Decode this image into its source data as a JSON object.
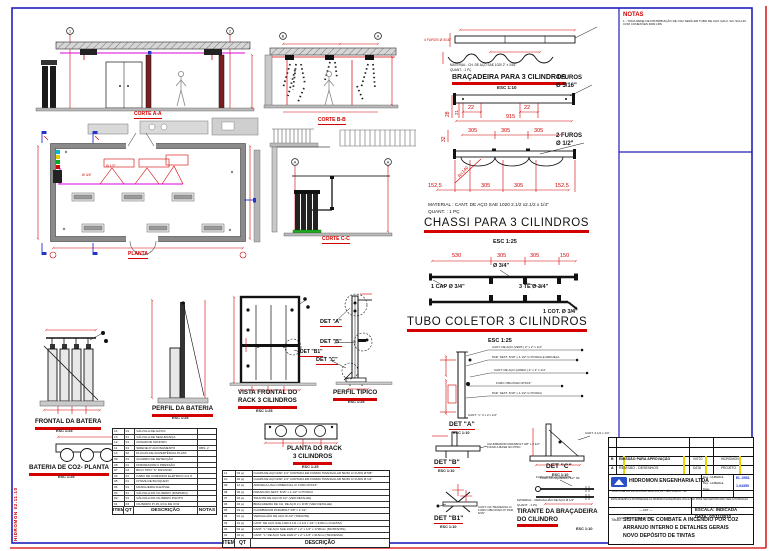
{
  "stamp": {
    "text": "HIDROMON 02.11.10"
  },
  "notas": {
    "title": "NOTAS",
    "line": "1 - TODA REDE DE DISTRIBUIÇÃO DE CO2 SERÁ EM TUBO DE AÇO GALV. S/C SCH-40 COM CONEXÕES 3000 LBS."
  },
  "cortes": {
    "a": "CORTE A-A",
    "b": "CORTE B-B",
    "c": "CORTE C-C",
    "planta": "PLANTA",
    "col1": "1",
    "col2": "2",
    "colA": "A",
    "colB": "B"
  },
  "plan": {
    "d12": "Ø 1/2\"",
    "d34": "Ø 3/4\""
  },
  "bracadeira": {
    "red_note": "4 FUROS Ø 5/16\"",
    "material": "MATERIAL : CH. DE AÇO SAE 1020 2\" x 3/16\"",
    "quant": "QUANT.   : 1 PÇ",
    "title": "BRAÇADEIRA PARA 3 CILINDROS",
    "esc": "ESC 1:10",
    "furos4a": "4 FUROS",
    "furos4b": "Ø 5/16\"",
    "furos2a": "2 FUROS",
    "furos2b": "Ø 1/2\"",
    "d28": "28",
    "d21": "21",
    "d22a": "22",
    "d22b": "22",
    "d915": "915",
    "d305a": "305",
    "d305b": "305",
    "d305c": "305",
    "d32": "32",
    "r140": "R=140",
    "d1525a": "152,5",
    "d305d": "305",
    "d305e": "305",
    "d1525b": "152,5"
  },
  "chassi": {
    "material": "MATERIAL : CANT. DE AÇO SAE 1020 2.1/2 x2.1/2 x 1/4\"",
    "quant": "QUANT.   : 1 PÇ",
    "title": "CHASSI PARA 3 CILINDROS",
    "esc": "ESC 1:25"
  },
  "tubo": {
    "d530": "530",
    "d305a": "305",
    "d305b": "305",
    "d150": "150",
    "d34": "Ø 3/4\"",
    "cap": "1 CAP Ø 3/4\"",
    "te": "3 TE Ø 3/4\"",
    "cot": "1 COT. Ø 3/4\"",
    "title": "TUBO COLETOR 3 CILINDROS",
    "esc": "ESC 1:25"
  },
  "views": {
    "frontal": "FRONTAL DA BATERA",
    "perfil_bateria": "PERFIL DA BATERIA",
    "bateria_planta": "BATERIA DE CO2- PLANTA",
    "vista1": "VISTA FRONTAL DO",
    "vista2": "RACK 3 CILINDROS",
    "perfil_tipico": "PERFIL TIPICO",
    "planta_rack1": "PLANTA DO RACK",
    "planta_rack2": "3 CILINDROS",
    "esc125": "ESC 1:25"
  },
  "dets": {
    "a": "DET \"A\"",
    "b": "DET \"B\"",
    "c": "DET \"C\"",
    "b1": "DET \"B1\"",
    "esc110": "ESC 1:10",
    "a_notes": [
      "CANT. DE AÇO (VERT.) 2\" x 2\" x 1/4\"",
      "PAR. SEXT. 5/16\" x 1.1/2\" C/ PORCA E ARRUELA",
      "CANT. DE AÇO (HORIZ.) 2\" x 2\" x 1/4\"",
      "FURO OBLONGO Ø 5/16\"",
      "PAR. SEXT. 5/16\" x 1.1/2\" C/ PORCA",
      "CANT. \"L\" 2 x 2 x 1/4\""
    ],
    "b_note": "CHUMBADOR PARABOLT 3/8\" x 2.1/2\" FIXAR A BASE NO PISO",
    "c_note1": "CANT. 2.1/2 x 1/4\"",
    "c_note2": "FURO Ø 5/8\" P/ TIRANTE",
    "b1_note": "CANT. DA TRAVESSA C/ FURO OBLONGO P/ PAR. 5/16\""
  },
  "tirante": {
    "note": "FURO ROSQUEADO 1/2\" NF",
    "material": "MATERIAL : VERGALHÃO DE AÇO Ø 1/2\"",
    "quant": "QUANT. : 1 PÇ",
    "t1": "TIRANTE DA BRAÇADEIRA",
    "t2": "DO CILINDRO",
    "esc": "ESC 1:10"
  },
  "left_table": {
    "widths": [
      10,
      9,
      63,
      18
    ],
    "headers": [
      "ITEM",
      "QT",
      "DESCRIÇÃO",
      "NOTAS"
    ],
    "rows": [
      [
        "14",
        "01",
        "VÁLVULA DE ALÍVIO",
        ""
      ],
      [
        "13",
        "01",
        "VÁLVULA DE SEGURANÇA",
        ""
      ],
      [
        "12",
        "01",
        "AVISADOR SONORO",
        ""
      ],
      [
        "11",
        "01",
        "SIRENE P/ ACIONAMENTO",
        "OBS. 2"
      ],
      [
        "10",
        "02",
        "PLACAS DE ADVERTÊNCIA PLÁST.",
        ""
      ],
      [
        "09",
        "01",
        "QUADRO DE DETECÇÃO",
        ""
      ],
      [
        "08",
        "01",
        "DISPARADOR A PRESSÃO",
        ""
      ],
      [
        "07",
        "03",
        "BICO TIPO \"S\" DIFUSOR",
        ""
      ],
      [
        "06",
        "01",
        "CABO DE COMANDO ELÉTRICO 2x1,5",
        ""
      ],
      [
        "05",
        "01",
        "CHAVE DE BLOQUEIO",
        ""
      ],
      [
        "04",
        "01",
        "MANGUEIRA FLEXÍVEL",
        ""
      ],
      [
        "03",
        "01",
        "VÁLVULA DO CILINDRO (DISPARO)",
        ""
      ],
      [
        "02",
        "01",
        "VÁLVULA DO CILINDRO PILOTO",
        ""
      ],
      [
        "01",
        "03",
        "CILINDRO P/ 45,4 KG DE CO2",
        ""
      ]
    ]
  },
  "right_table": {
    "widths": [
      11,
      15,
      138
    ],
    "headers": [
      "ITEM",
      "QT",
      "DESCRIÇÃO"
    ],
    "rows": [
      [
        "11",
        "02 pç",
        "CHAPA DE AÇO ESP. 1/4\" CORTADA EM FORMA TRIANGULAR 50x50 C/ FURO Ø 5/8\""
      ],
      [
        "10",
        "02 pç",
        "CHAPA DE AÇO ESP. 1/4\" CORTADA EM FORMA TRIANGULAR 50x50 C/ FURO Ø 1/2\""
      ],
      [
        "09",
        "12 pç",
        "ARRUELA LISA COMERCIAL C/ FURO Ø 5/16\""
      ],
      [
        "08",
        "06 pç",
        "PARAFUSO SEXT. 5/16\" x 1.1/2\" C/ PORCA"
      ],
      [
        "07",
        "02 pç",
        "TIRANTE DE AÇO Ø 1/2\" (VER DETALHE)"
      ],
      [
        "06",
        "02 pç",
        "BRAÇADEIRA DE CH. DE AÇO 2 x 3/16\" (VER DETALHE)"
      ],
      [
        "05",
        "04 pç",
        "CHUMBADOR PARABOLT 3/8\" x 2.1/2\""
      ],
      [
        "04",
        "01 pç",
        "VERGALHÃO DE AÇO Ø 1/2\" (TIRANTE)"
      ],
      [
        "03",
        "01 pç",
        "CANT. DE AÇO SAE 1020 2.1/2 x 2.1/2 x 1/4\" x 915mm (CHASSI)"
      ],
      [
        "02",
        "02 pç",
        "CANT. \"L\" DE AÇO SAE 1020 2\" x 2\" x 1/4\" x 1700mm (MONTANTE)"
      ],
      [
        "01",
        "02 pç",
        "CANT. \"L\" DE AÇO SAE 1020 2\" x 2\" x 1/4\" x 915mm (TRAVESSA)"
      ]
    ]
  },
  "titleblock": {
    "rev1_mark": "B",
    "rev1_desc": "EMISSÃO PARA APROVAÇÃO",
    "rev1_c3": "VISTO",
    "rev1_c4": "HIDROMON",
    "rev2_mark": "A",
    "rev2_desc": "REVISÃO - DESENHOS",
    "rev2_c3": "DATA",
    "rev2_c4": "PROJETO",
    "company": "HIDROMON ENGENHARIA LTDA",
    "address": "RUA JOSÉ DO PATROCÍNIO BASTOS, 85 - SÃO PAULO - SP",
    "legal": "ESTE DESENHO É PROPRIEDADE DA HIDROMON ENGENHARIA LTDA E NÃO PODE SER REPRODUZIDO SEM AUTORIZAÇÃO",
    "des_label": "Des.:",
    "des_value": "HUBERLE",
    "res_label": "Res.:",
    "res_value": "HUBERLE",
    "data_label": "Data:",
    "code1": "EL-0951",
    "code2": "1.04350",
    "art": "— ART —",
    "resp": "ENG. RESP. CREA Nº SP",
    "escala": "ESCALA: INDICADA",
    "data": "DATA: 02/11/2010",
    "titulo_label": "Título:",
    "t1": "SISTEMA DE COMBATE A INCÊNDIO POR CO2",
    "t2": "ARRANJO INTERNO E DETALHES GERAIS",
    "t3": "NOVO DEPÓSITO DE TINTAS"
  }
}
